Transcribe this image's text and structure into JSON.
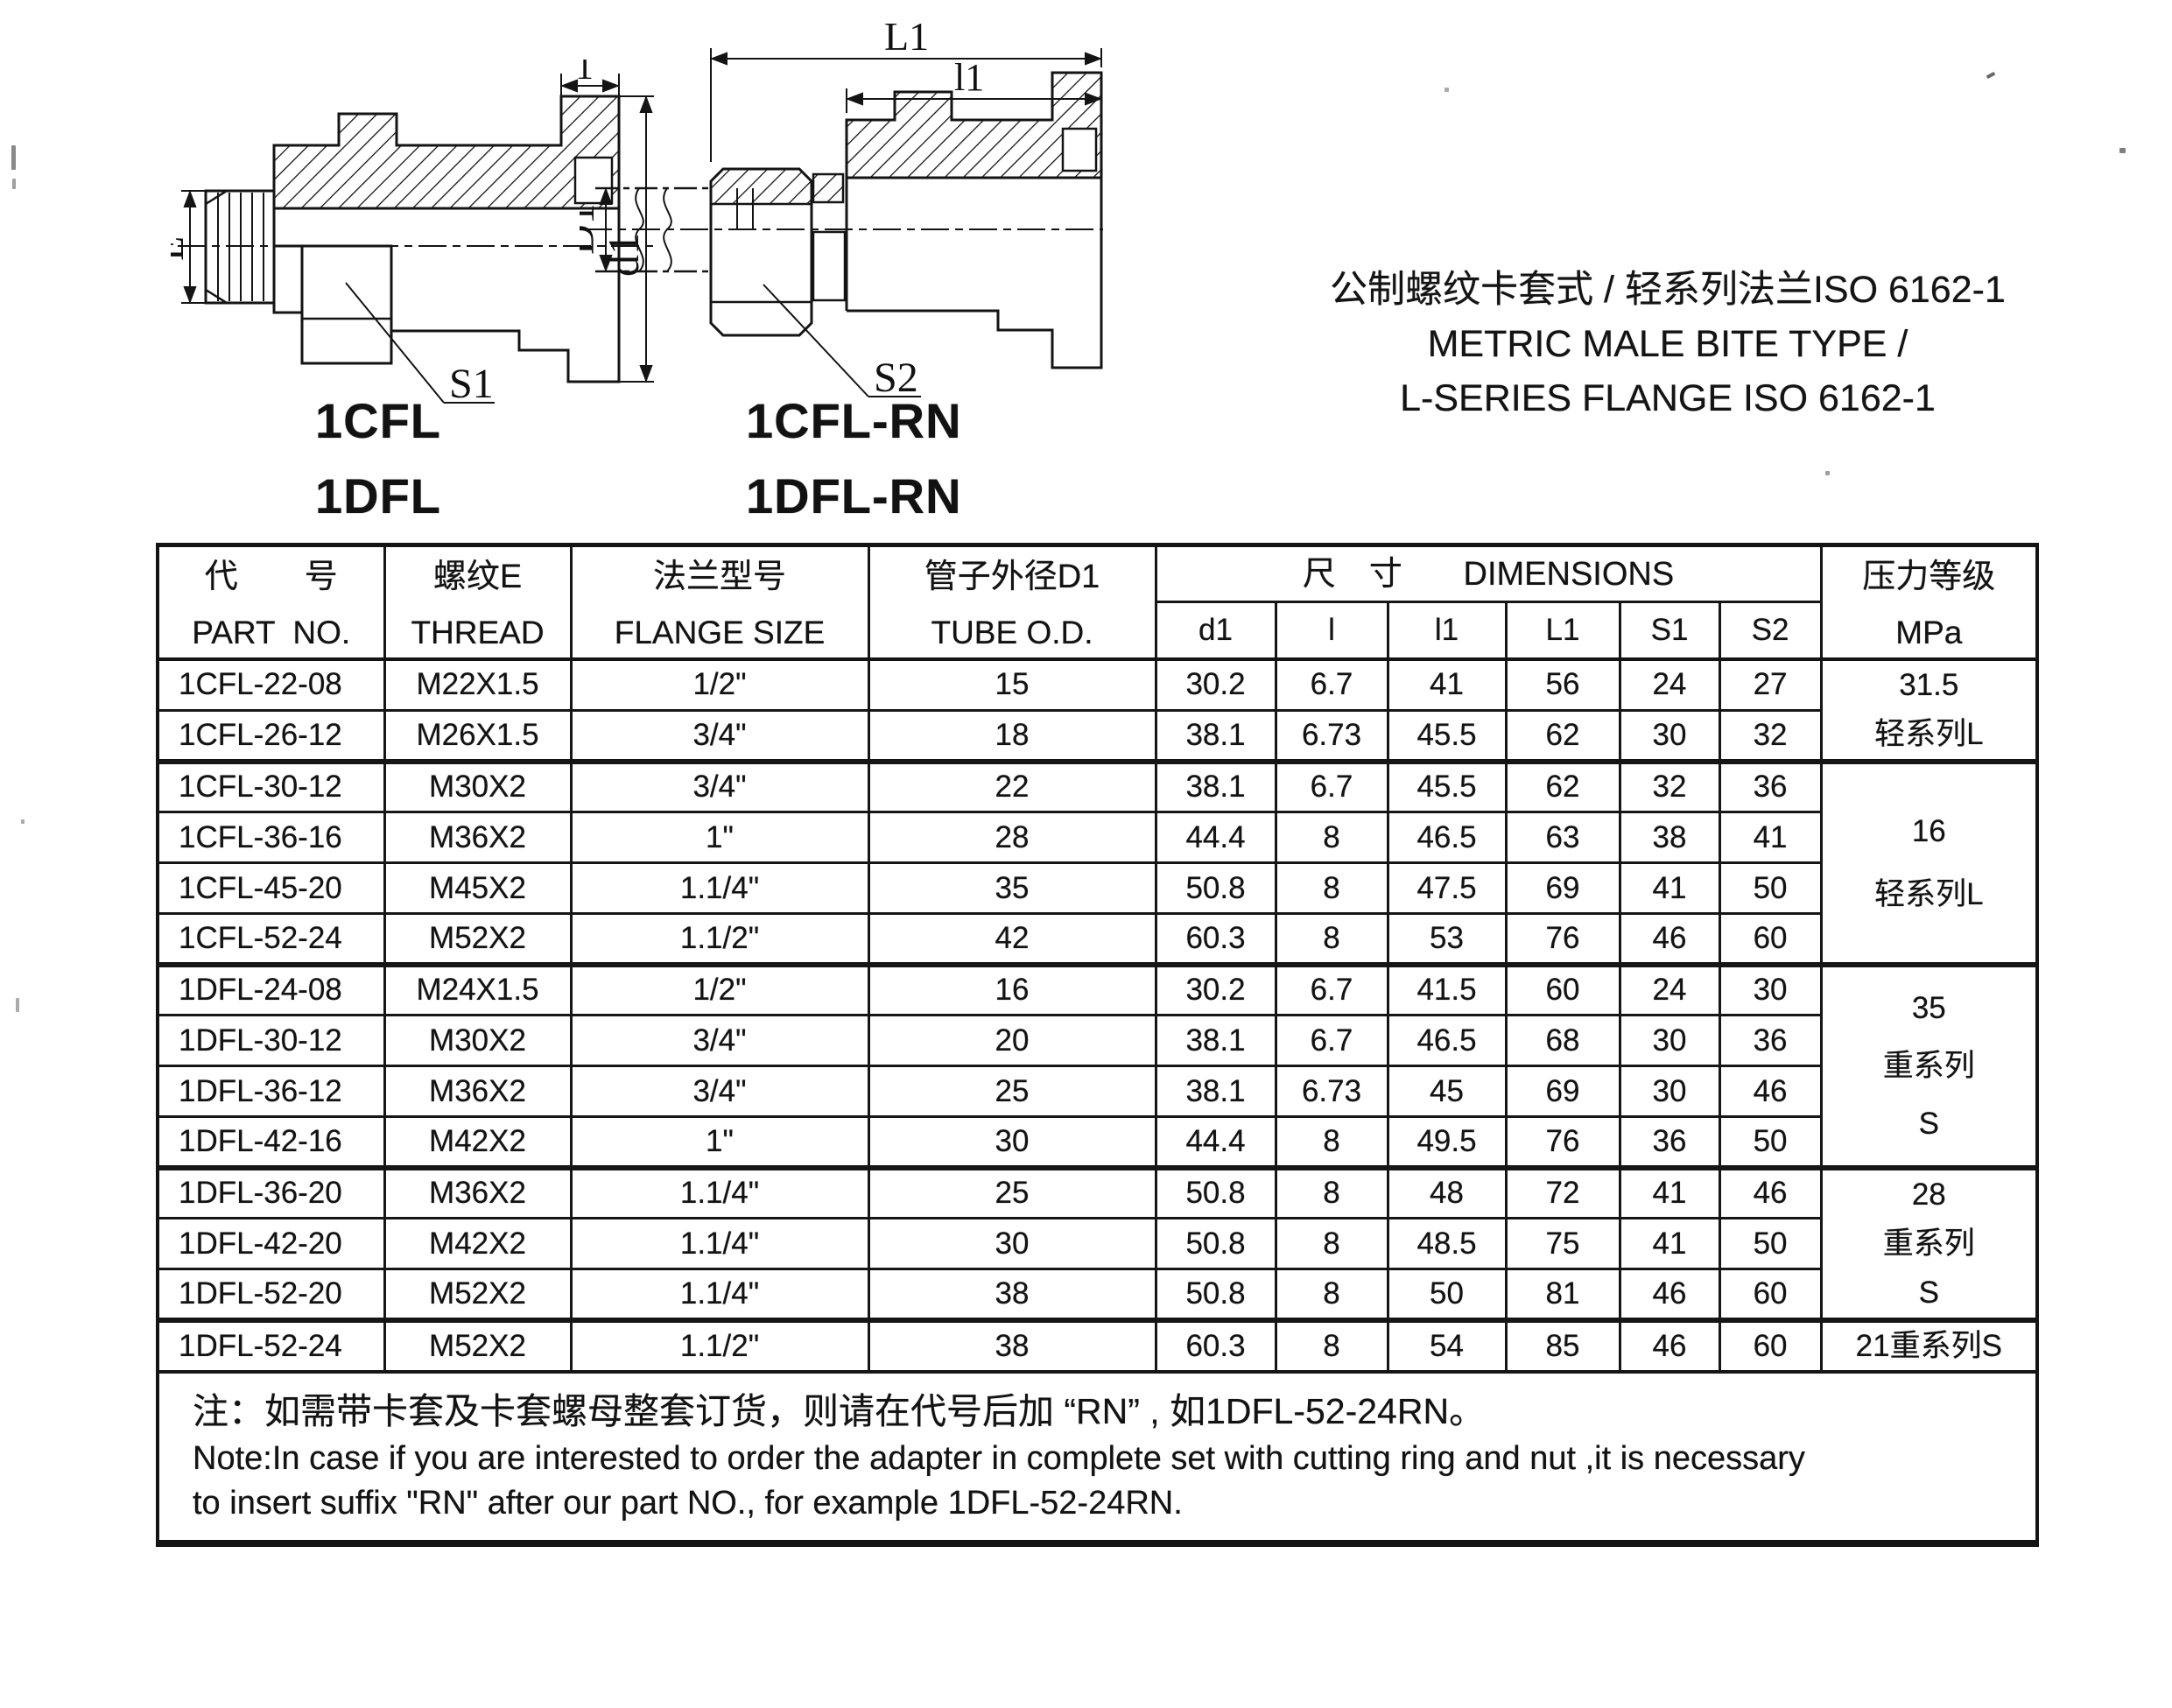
{
  "title": {
    "line_zh": "公制螺纹卡套式 / 轻系列法兰ISO 6162-1",
    "line_en1": "METRIC MALE BITE TYPE /",
    "line_en2": "L-SERIES FLANGE ISO 6162-1"
  },
  "models": [
    "1CFL",
    "1CFL-RN",
    "1DFL",
    "1DFL-RN"
  ],
  "drawings": {
    "left": {
      "dim_top": "1",
      "dim_left": "E",
      "dim_right": "d1",
      "leader": "S1"
    },
    "right": {
      "dim_top": "L1",
      "dim_mid": "l1",
      "dim_left": "D1",
      "leader": "S2"
    }
  },
  "table": {
    "headers": {
      "part_no_zh": "代　　号",
      "part_no_en": "PART  NO.",
      "thread_zh": "螺纹E",
      "thread_en": "THREAD",
      "flange_zh": "法兰型号",
      "flange_en": "FLANGE SIZE",
      "tube_zh": "管子外径D1",
      "tube_en": "TUBE O.D.",
      "dims": "尺　寸　   DIMENSIONS",
      "dim_cols": [
        "d1",
        "l",
        "l1",
        "L1",
        "S1",
        "S2"
      ],
      "pressure_zh": "压力等级",
      "pressure_en": "MPa"
    },
    "group_start_rows": [
      2,
      6,
      10,
      13
    ],
    "rows": [
      {
        "part": "1CFL-22-08",
        "thread": "M22X1.5",
        "flange": "1/2\"",
        "tube": "15",
        "d1": "30.2",
        "l": "6.7",
        "l1": "41",
        "L1": "56",
        "S1": "24",
        "S2": "27"
      },
      {
        "part": "1CFL-26-12",
        "thread": "M26X1.5",
        "flange": "3/4\"",
        "tube": "18",
        "d1": "38.1",
        "l": "6.73",
        "l1": "45.5",
        "L1": "62",
        "S1": "30",
        "S2": "32"
      },
      {
        "part": "1CFL-30-12",
        "thread": "M30X2",
        "flange": "3/4\"",
        "tube": "22",
        "d1": "38.1",
        "l": "6.7",
        "l1": "45.5",
        "L1": "62",
        "S1": "32",
        "S2": "36"
      },
      {
        "part": "1CFL-36-16",
        "thread": "M36X2",
        "flange": "1\"",
        "tube": "28",
        "d1": "44.4",
        "l": "8",
        "l1": "46.5",
        "L1": "63",
        "S1": "38",
        "S2": "41"
      },
      {
        "part": "1CFL-45-20",
        "thread": "M45X2",
        "flange": "1.1/4\"",
        "tube": "35",
        "d1": "50.8",
        "l": "8",
        "l1": "47.5",
        "L1": "69",
        "S1": "41",
        "S2": "50"
      },
      {
        "part": "1CFL-52-24",
        "thread": "M52X2",
        "flange": "1.1/2\"",
        "tube": "42",
        "d1": "60.3",
        "l": "8",
        "l1": "53",
        "L1": "76",
        "S1": "46",
        "S2": "60"
      },
      {
        "part": "1DFL-24-08",
        "thread": "M24X1.5",
        "flange": "1/2\"",
        "tube": "16",
        "d1": "30.2",
        "l": "6.7",
        "l1": "41.5",
        "L1": "60",
        "S1": "24",
        "S2": "30"
      },
      {
        "part": "1DFL-30-12",
        "thread": "M30X2",
        "flange": "3/4\"",
        "tube": "20",
        "d1": "38.1",
        "l": "6.7",
        "l1": "46.5",
        "L1": "68",
        "S1": "30",
        "S2": "36"
      },
      {
        "part": "1DFL-36-12",
        "thread": "M36X2",
        "flange": "3/4\"",
        "tube": "25",
        "d1": "38.1",
        "l": "6.73",
        "l1": "45",
        "L1": "69",
        "S1": "30",
        "S2": "46"
      },
      {
        "part": "1DFL-42-16",
        "thread": "M42X2",
        "flange": "1\"",
        "tube": "30",
        "d1": "44.4",
        "l": "8",
        "l1": "49.5",
        "L1": "76",
        "S1": "36",
        "S2": "50"
      },
      {
        "part": "1DFL-36-20",
        "thread": "M36X2",
        "flange": "1.1/4\"",
        "tube": "25",
        "d1": "50.8",
        "l": "8",
        "l1": "48",
        "L1": "72",
        "S1": "41",
        "S2": "46"
      },
      {
        "part": "1DFL-42-20",
        "thread": "M42X2",
        "flange": "1.1/4\"",
        "tube": "30",
        "d1": "50.8",
        "l": "8",
        "l1": "48.5",
        "L1": "75",
        "S1": "41",
        "S2": "50"
      },
      {
        "part": "1DFL-52-20",
        "thread": "M52X2",
        "flange": "1.1/4\"",
        "tube": "38",
        "d1": "50.8",
        "l": "8",
        "l1": "50",
        "L1": "81",
        "S1": "46",
        "S2": "60"
      },
      {
        "part": "1DFL-52-24",
        "thread": "M52X2",
        "flange": "1.1/2\"",
        "tube": "38",
        "d1": "60.3",
        "l": "8",
        "l1": "54",
        "L1": "85",
        "S1": "46",
        "S2": "60"
      }
    ],
    "pressure_groups": [
      {
        "start": 0,
        "span": 2,
        "style": "sp2",
        "lines": [
          "31.5",
          "轻系列L"
        ]
      },
      {
        "start": 2,
        "span": 4,
        "style": "sp4-2",
        "lines": [
          "16",
          "轻系列L"
        ]
      },
      {
        "start": 6,
        "span": 4,
        "style": "sp4-3",
        "lines": [
          "35",
          "重系列",
          "S"
        ]
      },
      {
        "start": 10,
        "span": 3,
        "style": "sp3-3",
        "lines": [
          "28",
          "重系列",
          "S"
        ]
      },
      {
        "start": 13,
        "span": 1,
        "style": "single",
        "lines": [
          "21重系列S"
        ]
      }
    ],
    "note_zh": "注：如需带卡套及卡套螺母整套订货，则请在代号后加 “RN” , 如1DFL-52-24RN。",
    "note_en1": "Note:In case if you are interested to order the adapter in complete set with cutting ring and nut ,it is necessary",
    "note_en2": "to insert suffix \"RN\" after our part NO., for example 1DFL-52-24RN."
  }
}
